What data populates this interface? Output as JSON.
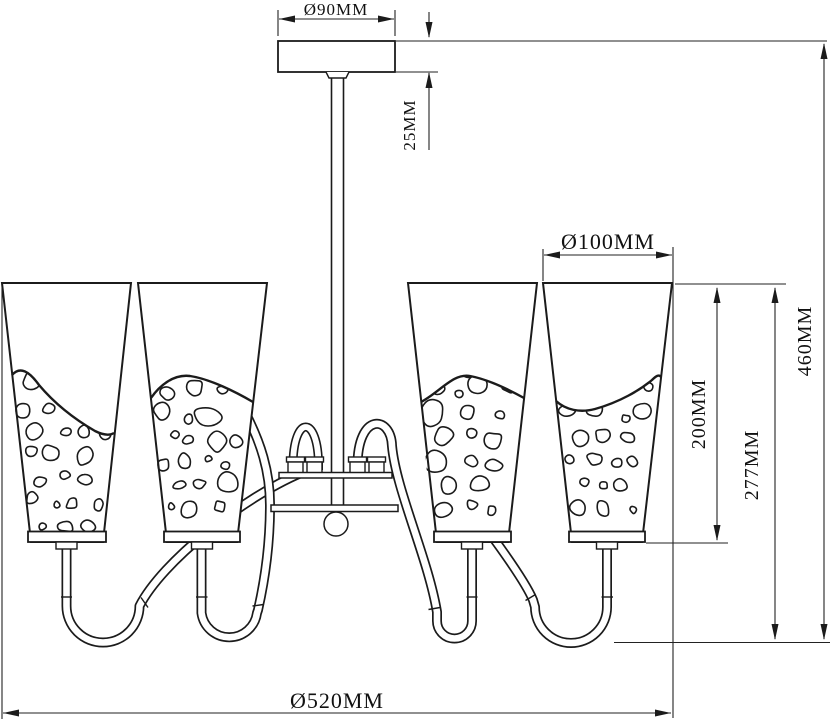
{
  "drawing": {
    "type": "chandelier technical dimension drawing",
    "shade_count": 4,
    "line_color": "#1b1b1b",
    "background": "#ffffff"
  },
  "dimensions": {
    "canopy_diameter": "Ø90MM",
    "canopy_height": "25MM",
    "shade_diameter": "Ø100MM",
    "shade_height": "200MM",
    "shade_drop_height": "277MM",
    "total_height": "460MM",
    "total_diameter": "Ø520MM"
  }
}
